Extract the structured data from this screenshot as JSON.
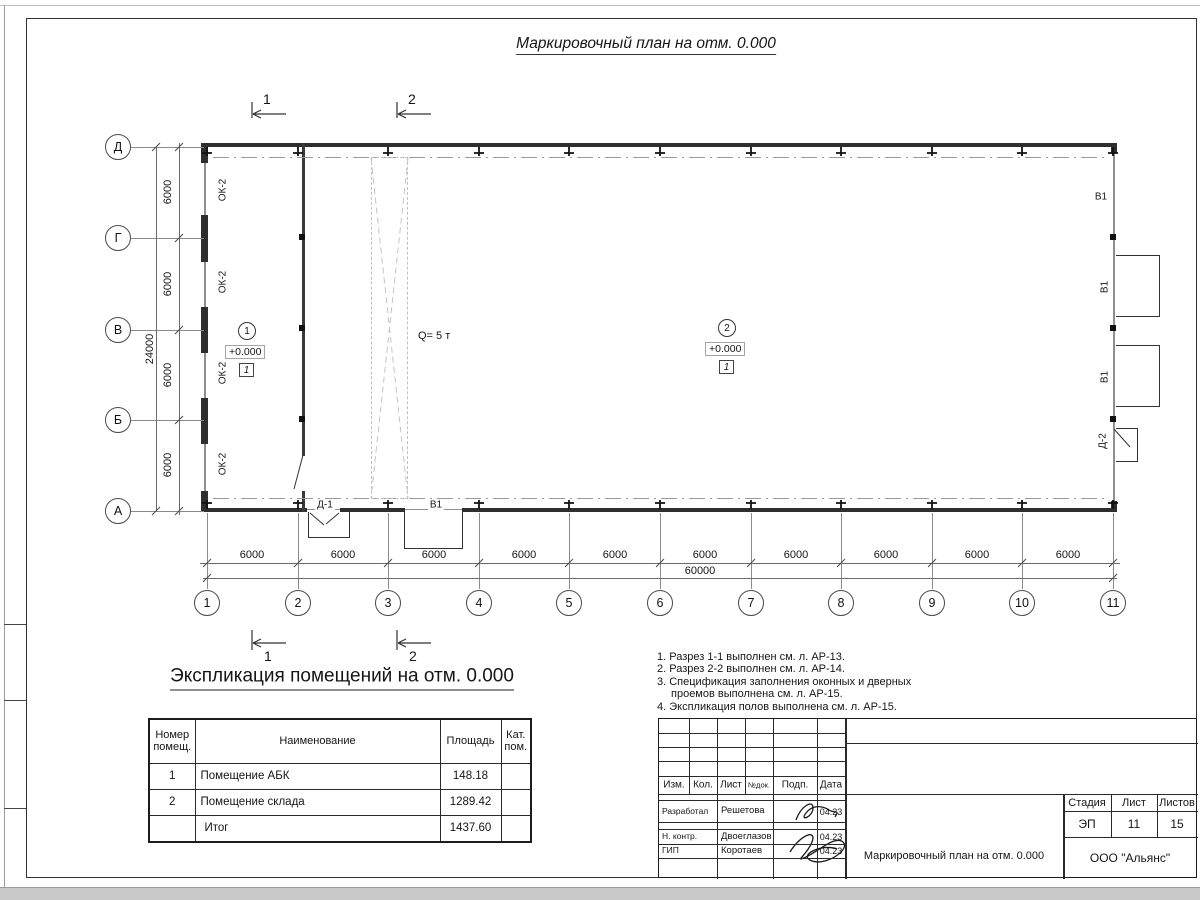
{
  "page": {
    "title": "Маркировочный план на отм. 0.000"
  },
  "plan": {
    "section_marks": [
      "1",
      "2"
    ],
    "row_axes": [
      "Д",
      "Г",
      "В",
      "Б",
      "А"
    ],
    "col_axes": [
      "1",
      "2",
      "3",
      "4",
      "5",
      "6",
      "7",
      "8",
      "9",
      "10",
      "11"
    ],
    "row_dims": [
      "6000",
      "6000",
      "6000",
      "6000"
    ],
    "row_total": "24000",
    "col_dims": [
      "6000",
      "6000",
      "6000",
      "6000",
      "6000",
      "6000",
      "6000",
      "6000",
      "6000",
      "6000"
    ],
    "col_total": "60000",
    "window_labels": [
      "ОК-2",
      "ОК-2",
      "ОК-2",
      "ОК-2"
    ],
    "gate_labels": {
      "top_right": "В1",
      "right_mid1": "В1",
      "right_mid2": "В1",
      "bottom": "В1"
    },
    "door_labels": {
      "d1": "Д-1",
      "d2": "Д-2"
    },
    "crane_label": "Q= 5 т",
    "rooms": [
      {
        "number": "1",
        "elevation": "+0.000",
        "floor_type": "1"
      },
      {
        "number": "2",
        "elevation": "+0.000",
        "floor_type": "1"
      }
    ]
  },
  "explication": {
    "title": "Экспликация помещений на отм. 0.000",
    "headers": [
      "Номер помещ.",
      "Наименование",
      "Площадь",
      "Кат. пом."
    ],
    "rows": [
      {
        "num": "1",
        "name": "Помещение АБК",
        "area": "148.18",
        "cat": ""
      },
      {
        "num": "2",
        "name": "Помещение склада",
        "area": "1289.42",
        "cat": ""
      },
      {
        "num": "",
        "name": "Итог",
        "area": "1437.60",
        "cat": ""
      }
    ]
  },
  "notes": {
    "lines": [
      "1. Разрез 1-1 выполнен см. л. АР-13.",
      "2. Разрез 2-2 выполнен см. л. АР-14.",
      "3. Спецификация заполнения оконных и дверных",
      "проемов выполнена см. л. АР-15.",
      "4. Экспликация полов выполнена см. л. АР-15."
    ]
  },
  "stamp": {
    "rev_headers": [
      "Изм.",
      "Кол.",
      "Лист",
      "№док.",
      "Подп.",
      "Дата"
    ],
    "signers": [
      {
        "role": "Разработал",
        "name": "Решетова",
        "date": "04.23"
      },
      {
        "role": "Н. контр.",
        "name": "Двоеглазов",
        "date": "04.23"
      },
      {
        "role": "ГИП",
        "name": "Коротаев",
        "date": "04.23"
      }
    ],
    "stage_headers": [
      "Стадия",
      "Лист",
      "Листов"
    ],
    "stage": "ЭП",
    "sheet_no": "11",
    "sheets_total": "15",
    "doc_title": "Маркировочный план на отм. 0.000",
    "company": "ООО \"Альянс\""
  }
}
